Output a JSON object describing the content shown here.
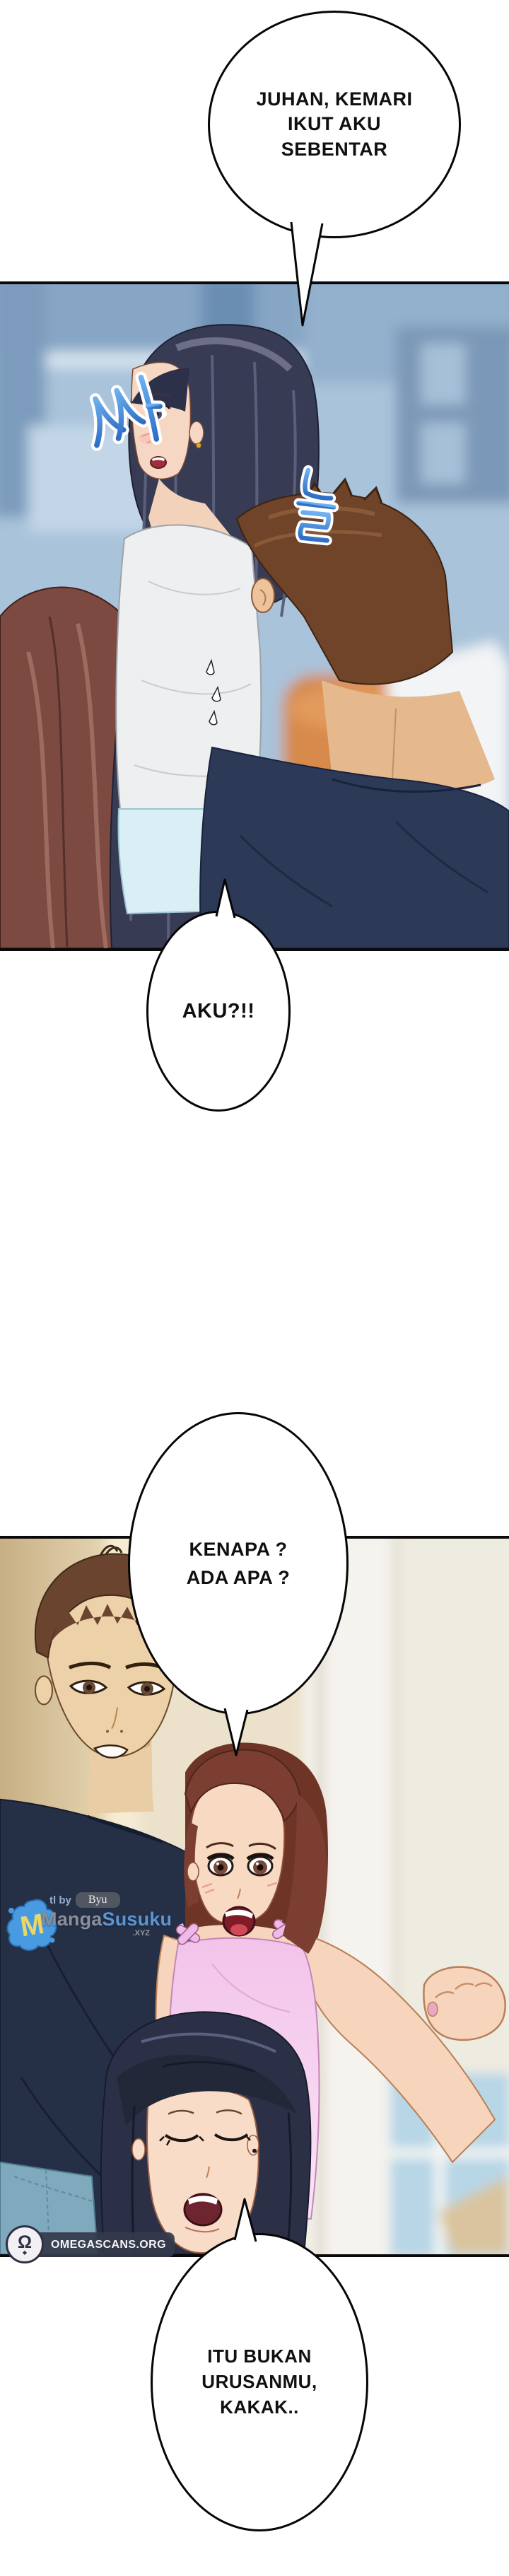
{
  "page": {
    "kind": "webtoon comic page",
    "language": "Indonesian",
    "background": "#ffffff"
  },
  "bubbles": {
    "b1": {
      "lines": [
        "JUHAN, KEMARI",
        "IKUT AKU",
        "SEBENTAR"
      ]
    },
    "b2": {
      "lines": [
        "AKU?!!"
      ]
    },
    "b3": {
      "lines": [
        "KENAPA ?",
        "ADA APA ?"
      ]
    },
    "b4": {
      "lines": [
        "ITU BUKAN",
        "URUSANMU,",
        "KAKAK.."
      ]
    }
  },
  "sfx": {
    "glyphs": [
      "싸",
      "늘"
    ],
    "fill": "#3f7fd2",
    "outline": "#ffffff"
  },
  "panels": {
    "p1": {
      "scene": "blurred blue room; black-haired girl looking back, red-brown haired woman foreground left, brown-haired man right"
    },
    "p2": {
      "scene": "cream hallway; surprised man left, shocked woman in pink camisole, black-haired girl eyes closed below"
    }
  },
  "watermarks": {
    "mangasusuku": {
      "tl_by_label": "tl by",
      "translator_name": "Byu",
      "logo_letter": "M",
      "wordmark_part1": "Manga",
      "wordmark_part2": "Susuku",
      "wordmark_suffix": ".XYZ"
    },
    "omegascans": {
      "site_label": "OMEGASCANS.ORG",
      "logo_glyph": "Ω",
      "logo_diamond": "◆"
    }
  },
  "colors": {
    "bubble_fill": "#ffffff",
    "bubble_outline": "#060606",
    "panel_border": "#0a0a0a",
    "sfx_blue": "#3f7fd2",
    "mangasusuku_blue": "#5f9bd8",
    "mangasusuku_gray": "#8e949e",
    "omegascans_band": "#343a4a"
  }
}
